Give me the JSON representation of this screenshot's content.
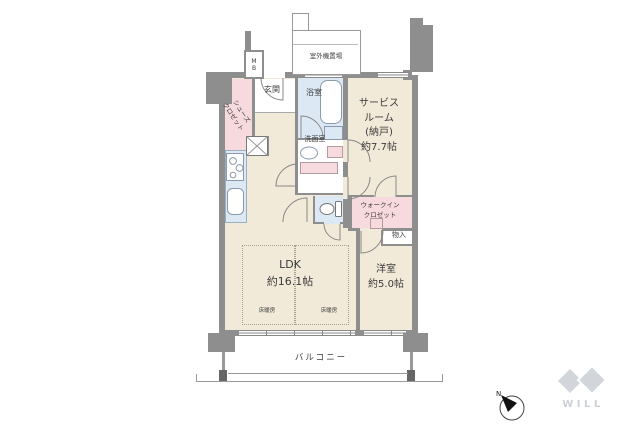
{
  "colors": {
    "wall": "#8e8e8e",
    "room_beige": "#f2ead8",
    "closet_pink": "#f7dade",
    "wet_blue": "#dce9f5",
    "logo_gray": "#d2d6da"
  },
  "rooms": {
    "ldk": {
      "label": "LDK\n約16.1帖"
    },
    "western_room": {
      "label": "洋室\n約5.0帖"
    },
    "service_room": {
      "label": "サービス\nルーム\n(納戸)\n約7.7帖"
    },
    "entrance": {
      "label": "玄関"
    },
    "bathroom": {
      "label": "浴室"
    },
    "washroom": {
      "label": "洗面室"
    },
    "shoe_closet": {
      "label": "シューズ\nクロゼット"
    },
    "walkin_closet": {
      "label": "ウォークイン\nクロゼット"
    },
    "storage": {
      "label": "物入"
    },
    "balcony": {
      "label": "バルコニー"
    },
    "outdoor_unit": {
      "label": "室外機置場"
    },
    "meter_box": {
      "label": "MB"
    }
  },
  "annotations": {
    "floor_heating_left": "床暖房",
    "floor_heating_right": "床暖房",
    "compass_north": "N",
    "brand": "WILL"
  }
}
